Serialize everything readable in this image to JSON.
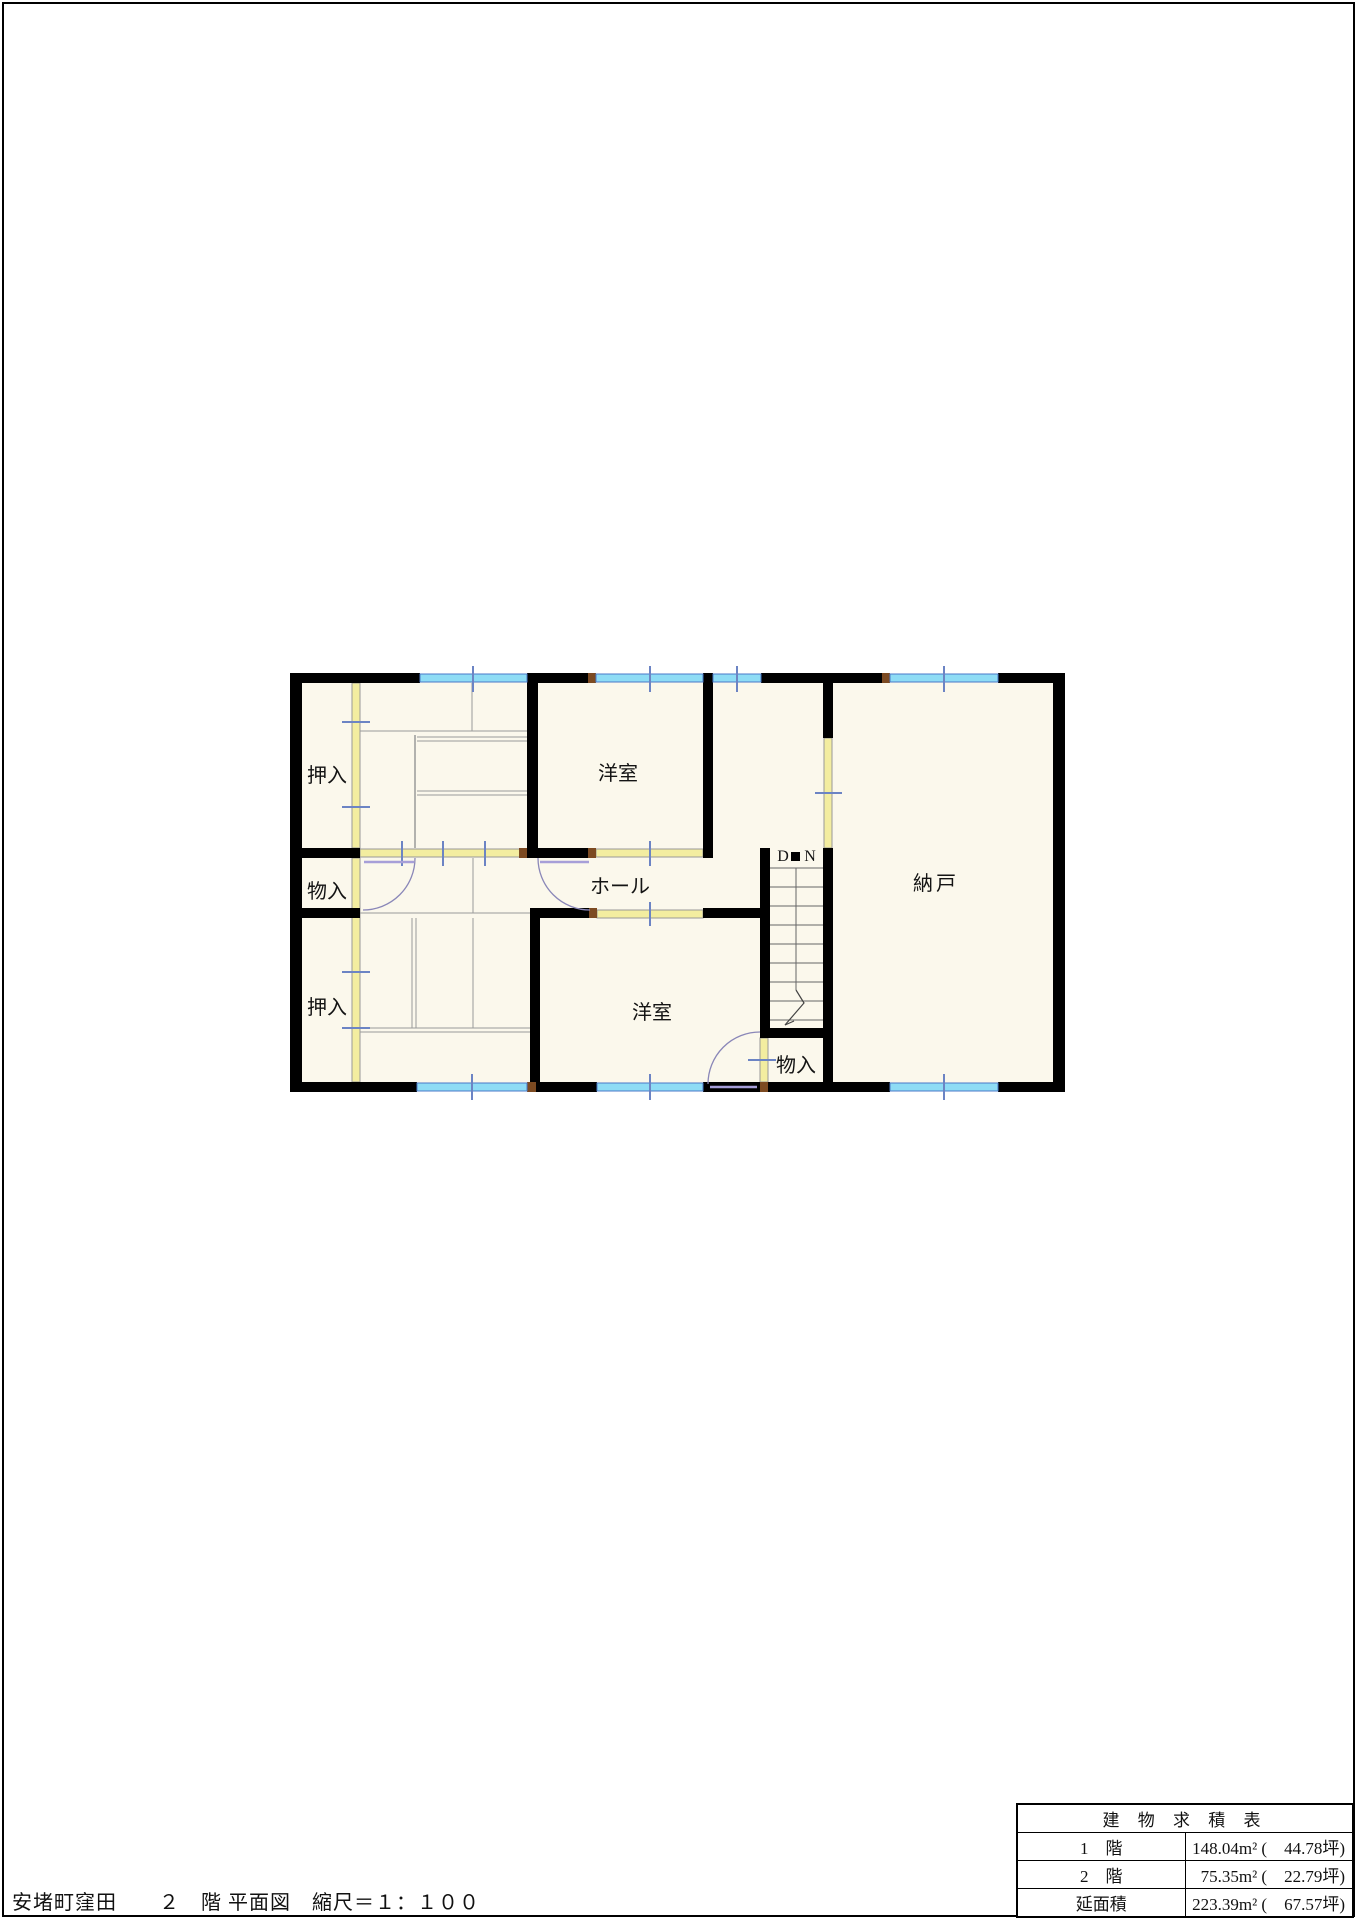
{
  "title_block": "安堵町窪田　　２　階 平面図　縮尺＝１：１００",
  "floorplan": {
    "labels": {
      "closet_top_left": "押入",
      "storage_left": "物入",
      "closet_bottom_left": "押入",
      "western_room_top": "洋室",
      "hall": "ホール",
      "western_room_bottom": "洋室",
      "storeroom": "納戸",
      "storage_by_stairs": "物入",
      "stairs_down_d": "D",
      "stairs_down_n": "N"
    },
    "colors": {
      "wall": "#000000",
      "room_fill": "#fbf8ec",
      "partition_fill": "#f3eda0",
      "window_fill": "#8edcf5",
      "window_stroke": "#4a78c8",
      "tick": "#6c84c4",
      "door_arc": "#8a87b8",
      "door_leaf": "#a79fd8",
      "tatami_line": "#9a9a9a",
      "post": "#7c4a21"
    }
  },
  "area_table": {
    "title": "建 物 求 積 表",
    "rows": [
      {
        "label": "1　階",
        "value": "148.04m² (　44.78坪)"
      },
      {
        "label": "2　階",
        "value": "75.35m² (　22.79坪)"
      },
      {
        "label": "延面積",
        "value": "223.39m² (　67.57坪)"
      }
    ]
  }
}
